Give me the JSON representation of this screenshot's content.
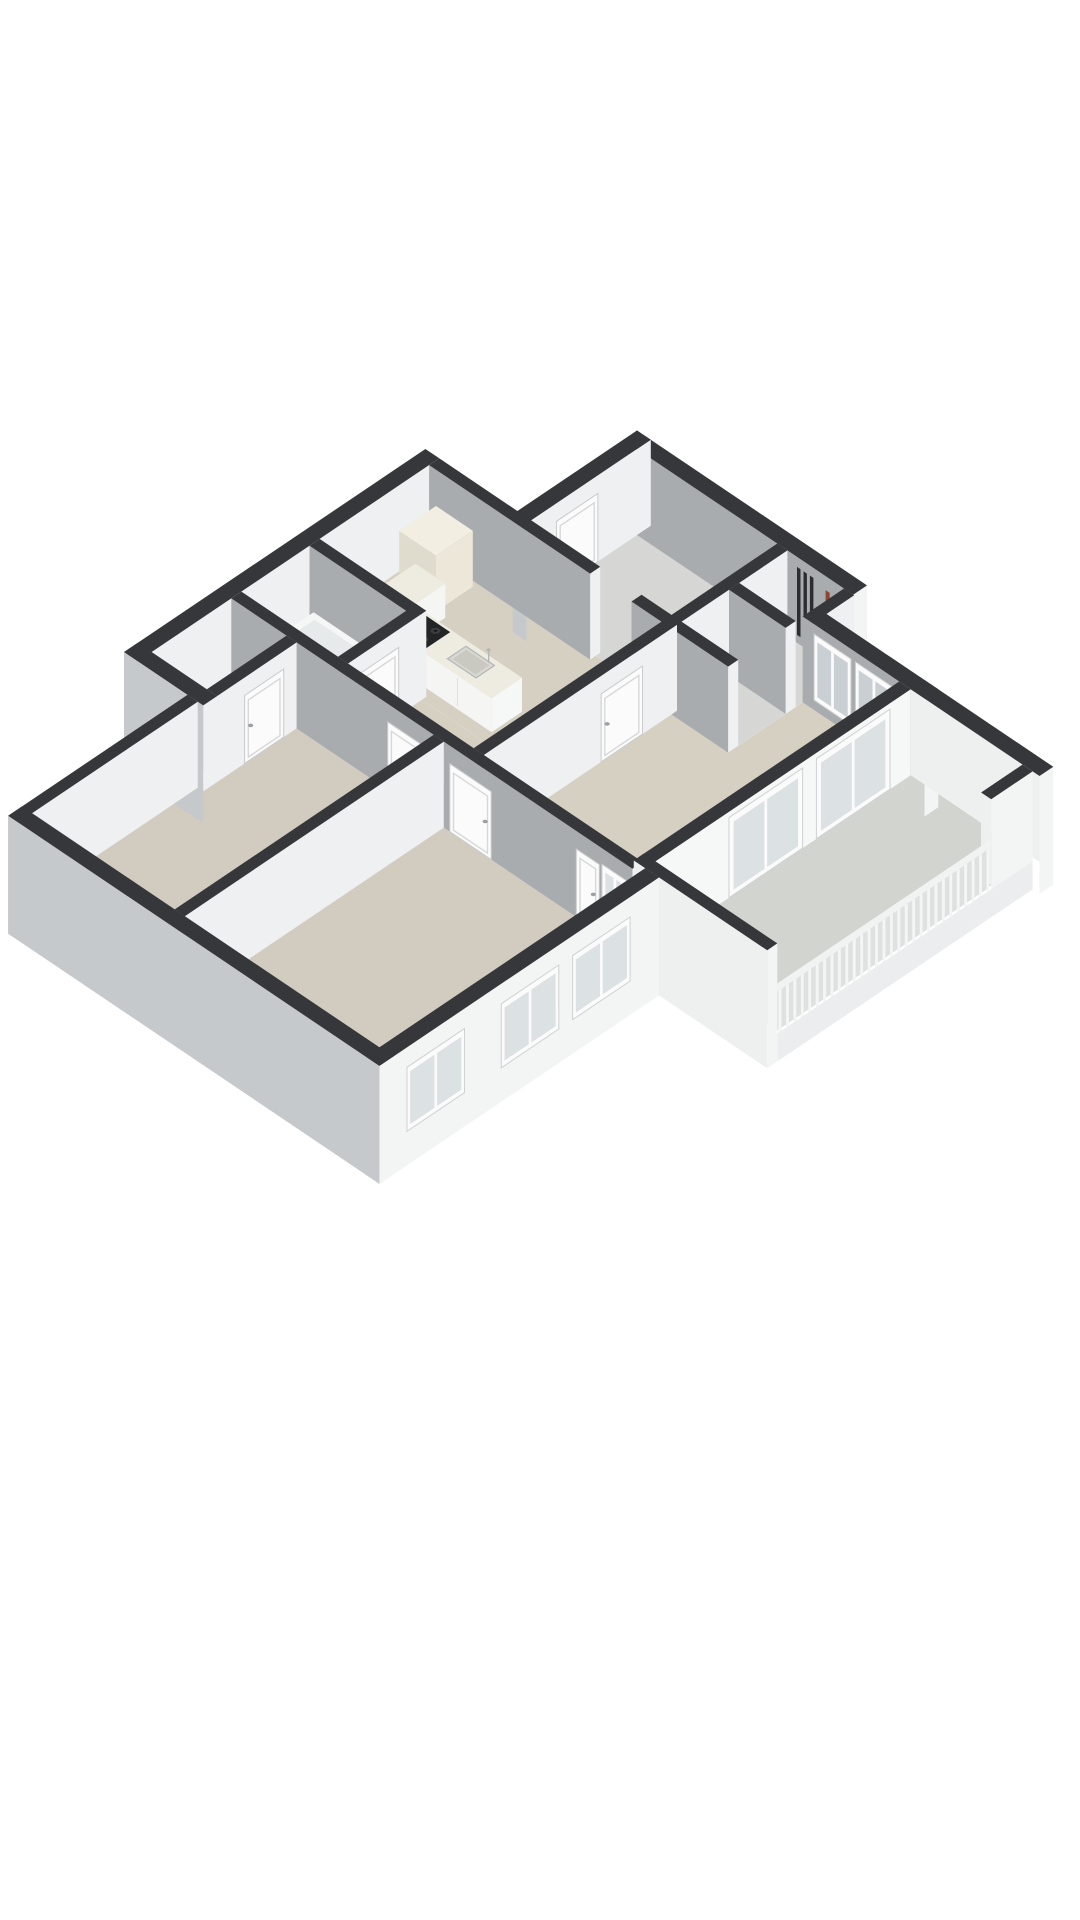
{
  "scene": {
    "type": "isometric-3d-floor-plan",
    "background": "#ffffff",
    "units": "meters"
  },
  "colors": {
    "wall_top": "#35373a",
    "wall_se": "#eef0f1",
    "wall_se_bright": "#f6f7f7",
    "wall_sw": "#a9acaf",
    "ext_sw": "#c6c9cb",
    "ext_se": "#f3f4f4",
    "floor_beige": "#d6d0c3",
    "floor_bedroom": "#d2ccc0",
    "floor_gray": "#d6d7d5",
    "floor_balcony": "#d2d4cf",
    "door": "#fbfbfb",
    "door_frame": "#d7d8d9",
    "door_edge": "#c9cbcc",
    "glass": "#dce1e4",
    "glass_dark": "#c9cfd2",
    "counter_body": "#f5f5f3",
    "counter_top": "#eeebe1",
    "cabinet_cream": "#ece7d8",
    "stove": "#232425",
    "burner": "#3b3d3e",
    "steel": "#b2b6b8",
    "sink_basin": "#d9d8d1",
    "radiator": "#2c2d2f",
    "radiator_accent": "#8e4434",
    "tub": "#f5f6f6",
    "tub_inner": "#e6eaeb",
    "rail_slat": "#f4f5f5",
    "rail_backing": "#dfe1e1",
    "slab": "#ecedee",
    "handle": "#9aa0a3"
  },
  "rooms": [
    {
      "id": "entrance-hall",
      "floor": "floor_gray"
    },
    {
      "id": "meter-closet",
      "floor": "floor_gray"
    },
    {
      "id": "storage-closet",
      "floor": "floor_gray"
    },
    {
      "id": "kitchen",
      "floor": "floor_beige"
    },
    {
      "id": "hallway",
      "floor": "floor_beige"
    },
    {
      "id": "living-room",
      "floor": "floor_beige"
    },
    {
      "id": "balcony",
      "floor": "floor_balcony"
    },
    {
      "id": "bathroom",
      "floor": "floor_beige"
    },
    {
      "id": "toilet",
      "floor": "floor_beige"
    },
    {
      "id": "bedroom-1",
      "floor": "floor_bedroom"
    },
    {
      "id": "bedroom-2",
      "floor": "floor_bedroom"
    }
  ],
  "fixtures": [
    "front-door",
    "entrance-step",
    "entrance-radiator",
    "radiator-red-pipe",
    "kitchen-counter",
    "gas-stove",
    "kitchen-sink",
    "tall-cabinet",
    "bathtub",
    "washbasin",
    "living-room-door",
    "bathroom-door",
    "toilet-door",
    "bedroom-1-door",
    "bedroom-2-door",
    "bedroom-2-second-door",
    "living-room-windows",
    "sliding-glass-doors",
    "bedroom-windows",
    "balcony-railing"
  ],
  "balcony": {
    "railing_slat_count": 28
  }
}
